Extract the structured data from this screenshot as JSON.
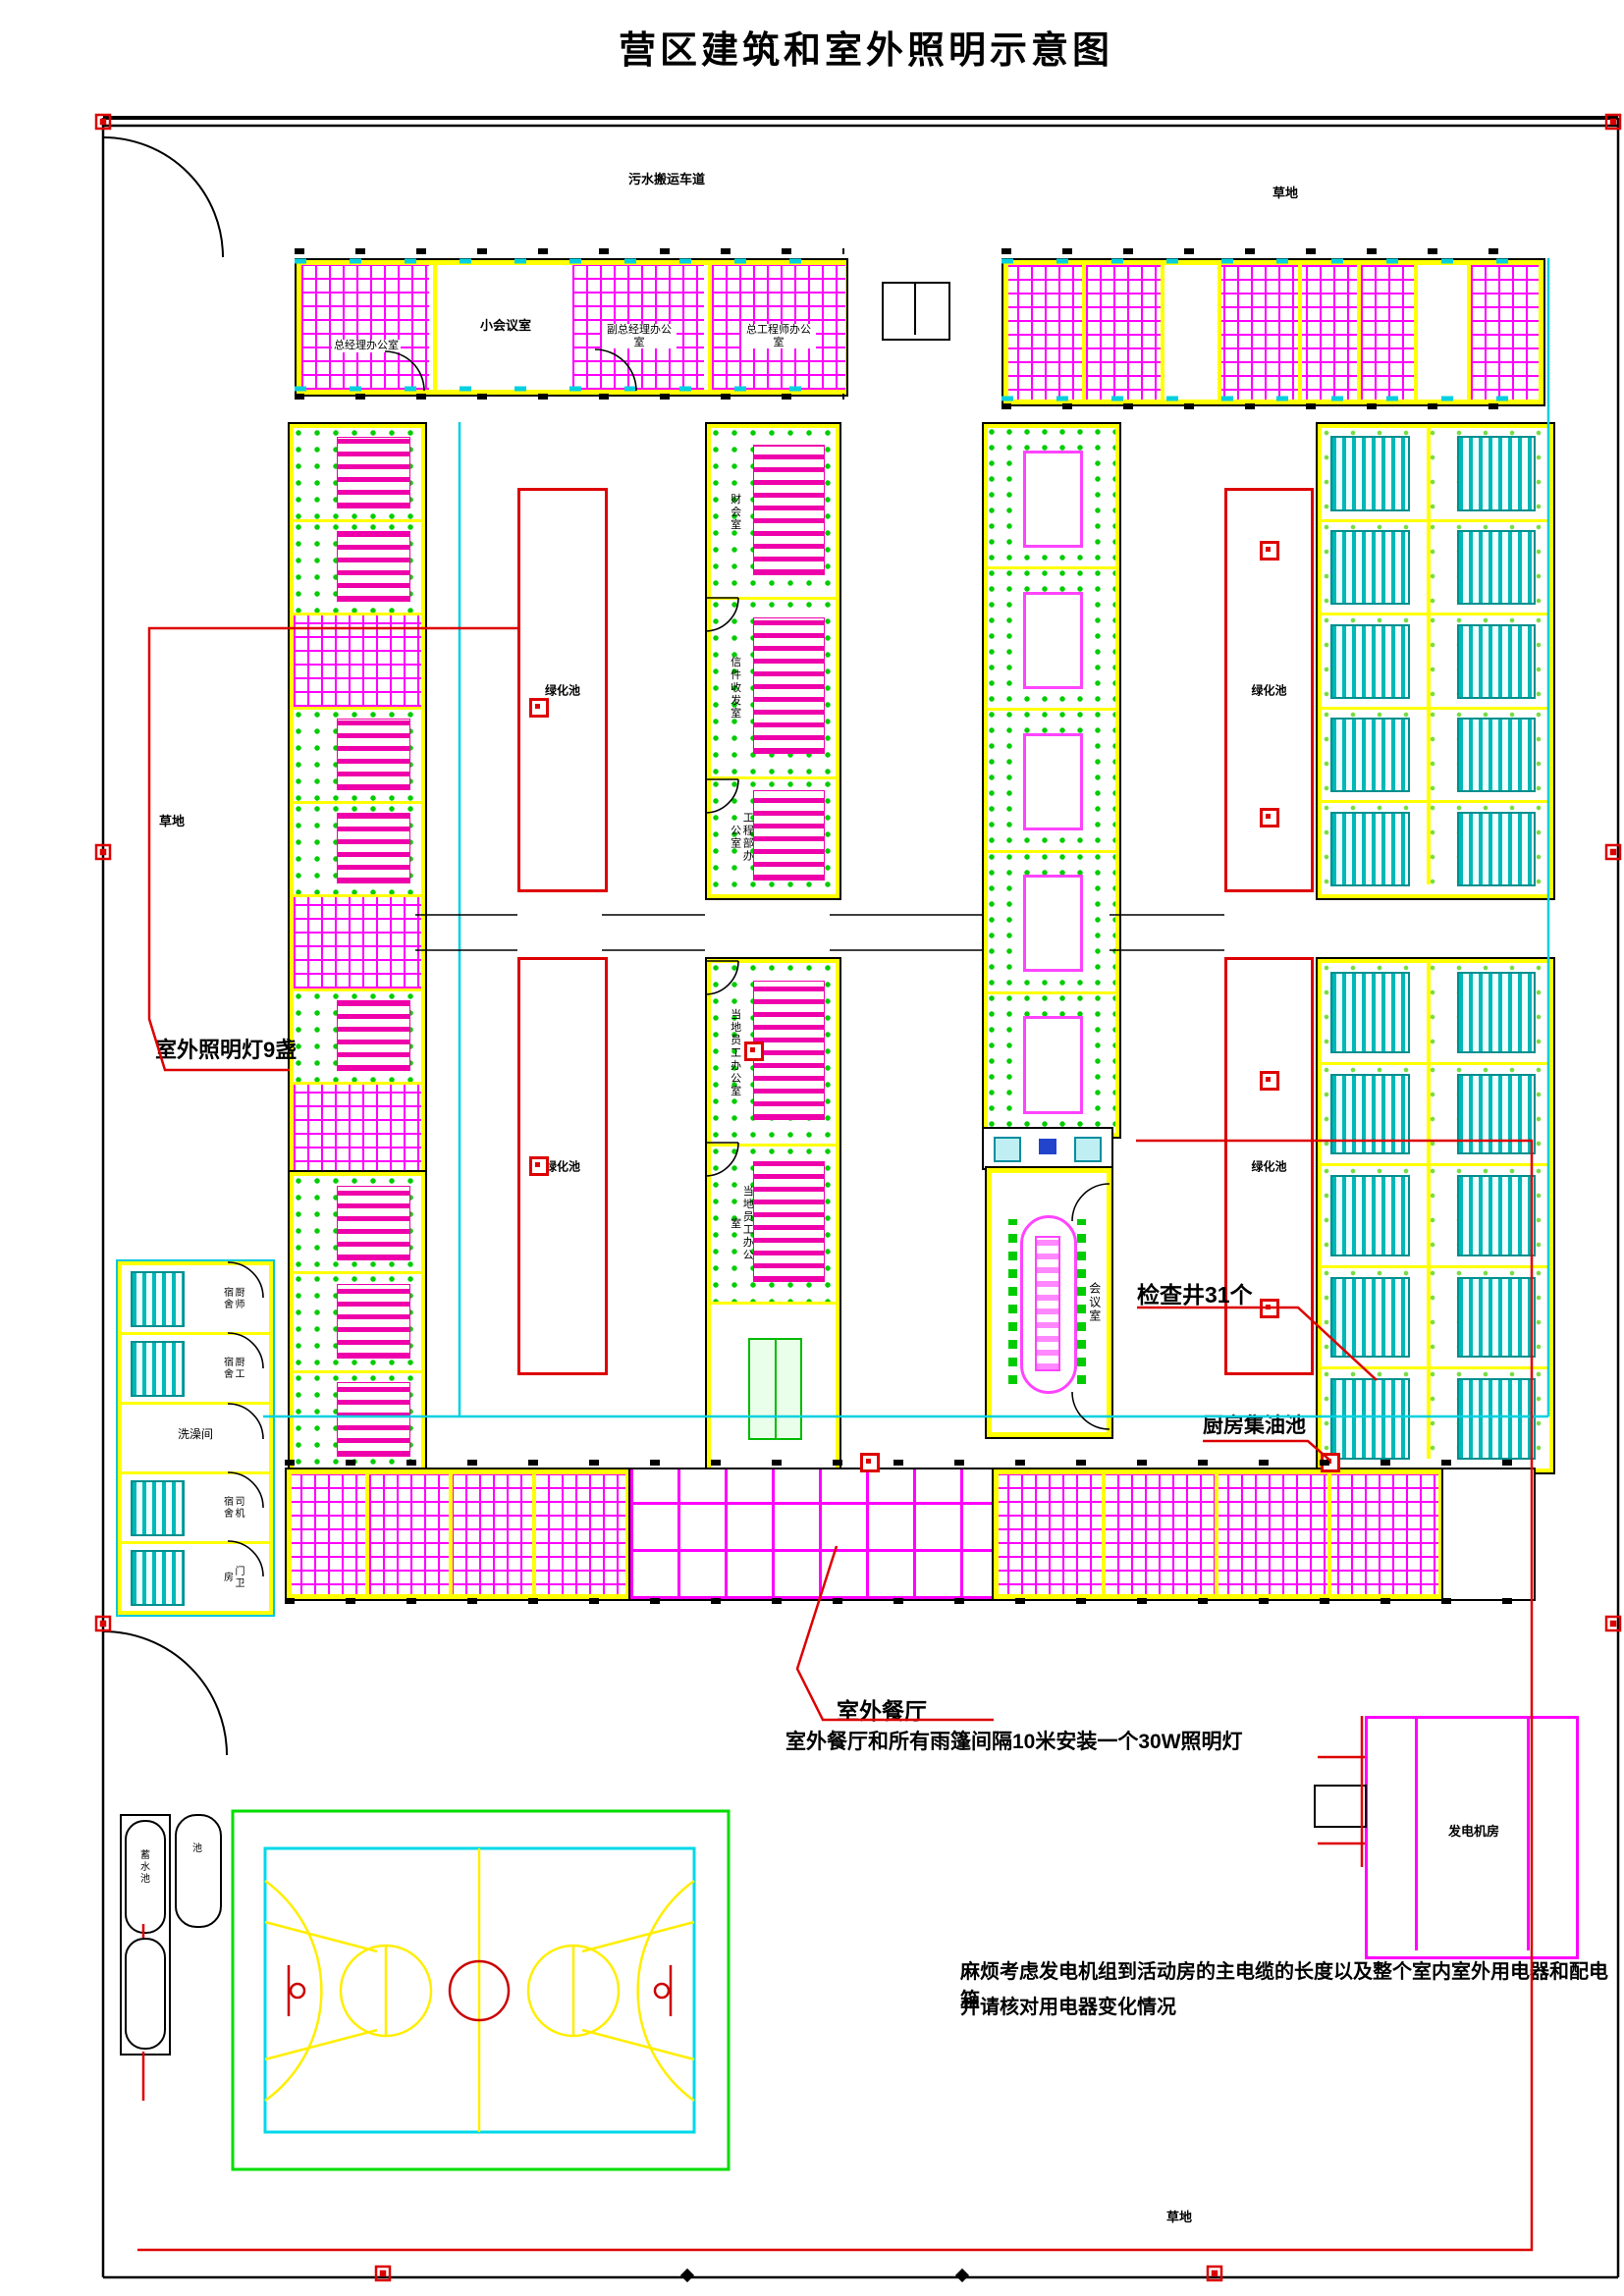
{
  "title": "营区建筑和室外照明示意图",
  "site": {
    "road_label": "污水搬运车道",
    "grass_top": "草地",
    "grass_left": "草地",
    "grass_bottom": "草地"
  },
  "building_a": {
    "room1": "总经理办公室",
    "room2": "小会议室",
    "room3": "副总经理办公室",
    "room4": "总工程师办公室"
  },
  "office_col": {
    "room1": "财会室",
    "room2": "信件收发室",
    "room3": "工程部办公室",
    "room4": "当地员工办公室",
    "room5": "当地员工办公室"
  },
  "service_bldg": {
    "room1": "厨师宿舍",
    "room2": "厨工宿舍",
    "room3": "洗澡间",
    "room4": "司机宿舍",
    "room5": "门卫房"
  },
  "meeting_room": "会议室",
  "green_pool": "绿化池",
  "generator": "发电机房",
  "tanks": {
    "main": "蓄水池",
    "small": "池"
  },
  "annotations": {
    "lights": "室外照明灯9盏",
    "wells": "检查井31个",
    "grease_pit": "厨房集油池",
    "outdoor_dining": "室外餐厅",
    "dining_note": "室外餐厅和所有雨篷间隔10米安装一个30W照明灯",
    "cable_note_1": "麻烦考虑发电机组到活动房的主电缆的长度以及整个室内室外用电器和配电箱",
    "cable_note_2": "并请核对用电器变化情况"
  }
}
